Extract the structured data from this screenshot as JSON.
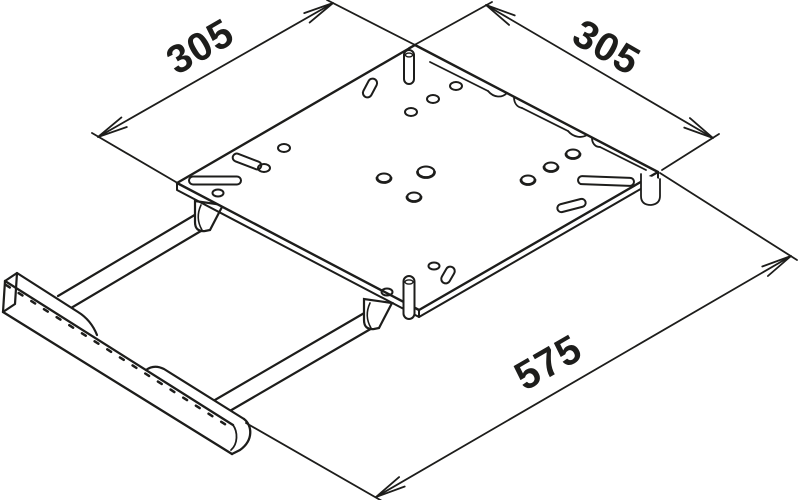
{
  "drawing": {
    "title": "Isometric technical line drawing of a pull-out sliding mounting plate with handle",
    "background_color": "#ffffff",
    "line_color": "#1d1d1b",
    "dimension_labels": {
      "plate_depth": "305",
      "plate_width": "305",
      "extended_length": "575"
    }
  }
}
